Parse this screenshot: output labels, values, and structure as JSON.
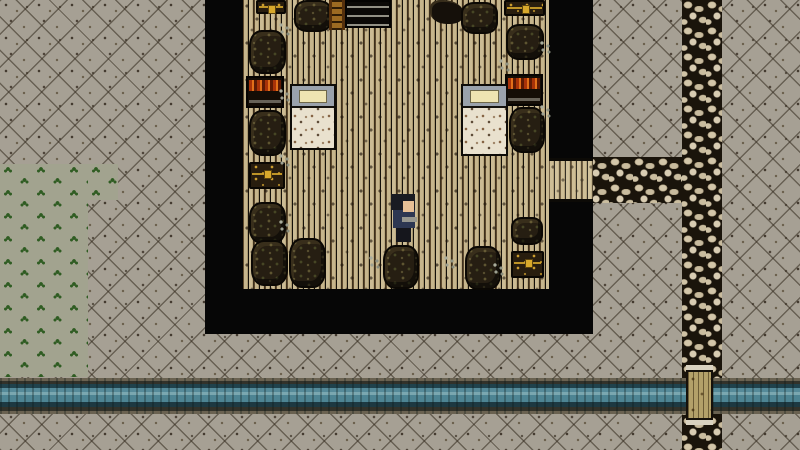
{
  "scene": {
    "type": "top-down-pixel-rpg",
    "viewport": {
      "width": 800,
      "height": 450
    },
    "colors": {
      "ground": "#a6a094",
      "grass": "#a2a38f",
      "sprout": "#2f5c22",
      "wood": "#bfae88",
      "wall": "#060606",
      "stone": "#d3c6a9",
      "stone_gap": "#1a140b",
      "water": "#4d8493",
      "bank": "#6a6251",
      "bridge": "#b3a069",
      "gold": "#d8a92c",
      "barrel": "#261e12",
      "chest": "#281d0e",
      "sheet": "#e9e1ce",
      "bedframe": "#9aa2ac",
      "pillow": "#eee4b2",
      "red_items": "#e2701a"
    },
    "entities": [
      {
        "type": "ground",
        "name": "exterior-ground",
        "x": 0,
        "y": 0,
        "w": 800,
        "h": 450,
        "interactable": false
      },
      {
        "type": "grass",
        "name": "grass-patch",
        "x": 0,
        "y": 164,
        "w": 88,
        "h": 213,
        "interactable": false
      },
      {
        "type": "grass",
        "name": "grass-patch-step",
        "x": 88,
        "y": 164,
        "w": 30,
        "h": 36,
        "interactable": false
      },
      {
        "type": "cobble",
        "name": "stone-path-vertical",
        "x": 682,
        "y": 0,
        "w": 40,
        "h": 450,
        "interactable": false
      },
      {
        "type": "cobble",
        "name": "stone-path-horizontal",
        "x": 585,
        "y": 157,
        "w": 97,
        "h": 46,
        "interactable": false
      },
      {
        "type": "river",
        "name": "river",
        "x": 0,
        "y": 378,
        "w": 800,
        "h": 36,
        "interactable": false
      },
      {
        "type": "bridge",
        "name": "wooden-bridge",
        "x": 686,
        "y": 370,
        "w": 27,
        "h": 50,
        "interactable": false
      },
      {
        "type": "wall",
        "name": "building-wall-left",
        "x": 205,
        "y": 0,
        "w": 38,
        "h": 334,
        "interactable": false
      },
      {
        "type": "wall",
        "name": "building-wall-bottom",
        "x": 205,
        "y": 289,
        "w": 388,
        "h": 45,
        "interactable": false
      },
      {
        "type": "wall",
        "name": "building-wall-right-top",
        "x": 549,
        "y": 0,
        "w": 44,
        "h": 158,
        "interactable": false
      },
      {
        "type": "wall",
        "name": "building-wall-right-bottom",
        "x": 549,
        "y": 202,
        "w": 44,
        "h": 88,
        "interactable": false
      },
      {
        "type": "floor",
        "name": "tavern-floor",
        "x": 243,
        "y": 0,
        "w": 306,
        "h": 289,
        "interactable": false
      },
      {
        "type": "porch",
        "name": "doorway-floor",
        "x": 549,
        "y": 158,
        "w": 44,
        "h": 44,
        "interactable": false
      },
      {
        "type": "chest",
        "name": "chest-top-left",
        "x": 256,
        "y": 0,
        "w": 30,
        "h": 14,
        "interactable": false
      },
      {
        "type": "barrel",
        "name": "barrel-top-1",
        "x": 294,
        "y": 0,
        "w": 38,
        "h": 32,
        "interactable": false
      },
      {
        "type": "ladder",
        "name": "ladder",
        "x": 329,
        "y": 0,
        "w": 16,
        "h": 30,
        "interactable": false
      },
      {
        "type": "shelf-dark",
        "name": "crate-shelf",
        "x": 345,
        "y": 0,
        "w": 46,
        "h": 28,
        "interactable": false
      },
      {
        "type": "tool",
        "name": "wall-tool",
        "x": 430,
        "y": 0,
        "w": 34,
        "h": 24,
        "interactable": false
      },
      {
        "type": "barrel",
        "name": "barrel-top-2",
        "x": 461,
        "y": 2,
        "w": 37,
        "h": 32,
        "interactable": false
      },
      {
        "type": "chest",
        "name": "chest-top-right",
        "x": 504,
        "y": 0,
        "w": 41,
        "h": 16,
        "interactable": false
      },
      {
        "type": "barrel",
        "name": "barrel-right-1",
        "x": 506,
        "y": 24,
        "w": 38,
        "h": 36,
        "interactable": false
      },
      {
        "type": "barrel",
        "name": "barrel-left-1",
        "x": 249,
        "y": 30,
        "w": 37,
        "h": 44,
        "interactable": false
      },
      {
        "type": "glint",
        "name": "floor-glint-1",
        "x": 278,
        "y": 22,
        "w": 14,
        "h": 16,
        "interactable": false
      },
      {
        "type": "shelf-red",
        "name": "weapon-shelf-left",
        "x": 246,
        "y": 76,
        "w": 38,
        "h": 32,
        "interactable": false
      },
      {
        "type": "shelf-red",
        "name": "weapon-shelf-right",
        "x": 505,
        "y": 74,
        "w": 38,
        "h": 32,
        "interactable": false
      },
      {
        "type": "bed",
        "name": "bed-left",
        "x": 290,
        "y": 84,
        "w": 46,
        "h": 66,
        "interactable": false
      },
      {
        "type": "bed",
        "name": "bed-right",
        "x": 461,
        "y": 84,
        "w": 47,
        "h": 72,
        "interactable": false
      },
      {
        "type": "barrel",
        "name": "barrel-left-2",
        "x": 249,
        "y": 110,
        "w": 37,
        "h": 46,
        "interactable": false
      },
      {
        "type": "barrel",
        "name": "barrel-right-2",
        "x": 509,
        "y": 107,
        "w": 36,
        "h": 46,
        "interactable": false
      },
      {
        "type": "glint",
        "name": "floor-glint-2",
        "x": 278,
        "y": 88,
        "w": 14,
        "h": 16,
        "interactable": false
      },
      {
        "type": "glint",
        "name": "floor-glint-3",
        "x": 539,
        "y": 40,
        "w": 14,
        "h": 16,
        "interactable": false
      },
      {
        "type": "glint",
        "name": "floor-glint-4",
        "x": 539,
        "y": 104,
        "w": 14,
        "h": 16,
        "interactable": false
      },
      {
        "type": "glint",
        "name": "floor-glint-5",
        "x": 498,
        "y": 58,
        "w": 14,
        "h": 16,
        "interactable": false
      },
      {
        "type": "chest",
        "name": "chest-left",
        "x": 249,
        "y": 162,
        "w": 36,
        "h": 27,
        "interactable": false
      },
      {
        "type": "glint",
        "name": "floor-glint-6",
        "x": 278,
        "y": 153,
        "w": 14,
        "h": 16,
        "interactable": false
      },
      {
        "type": "barrel",
        "name": "barrel-left-3",
        "x": 249,
        "y": 202,
        "w": 37,
        "h": 42,
        "interactable": false
      },
      {
        "type": "barrel",
        "name": "barrel-left-4",
        "x": 251,
        "y": 240,
        "w": 37,
        "h": 46,
        "interactable": false
      },
      {
        "type": "barrel",
        "name": "barrel-left-5",
        "x": 289,
        "y": 238,
        "w": 37,
        "h": 50,
        "interactable": false
      },
      {
        "type": "glint",
        "name": "floor-glint-7",
        "x": 278,
        "y": 219,
        "w": 14,
        "h": 16,
        "interactable": false
      },
      {
        "type": "barrel",
        "name": "barrel-center",
        "x": 383,
        "y": 245,
        "w": 36,
        "h": 44,
        "interactable": false
      },
      {
        "type": "barrel",
        "name": "barrel-bottom-right",
        "x": 465,
        "y": 246,
        "w": 36,
        "h": 44,
        "interactable": false
      },
      {
        "type": "barrel",
        "name": "barrel-right-3",
        "x": 511,
        "y": 217,
        "w": 32,
        "h": 28,
        "interactable": false
      },
      {
        "type": "chest",
        "name": "chest-bottom-right",
        "x": 511,
        "y": 251,
        "w": 33,
        "h": 27,
        "interactable": false
      },
      {
        "type": "glint",
        "name": "floor-glint-8",
        "x": 443,
        "y": 255,
        "w": 12,
        "h": 14,
        "interactable": false
      },
      {
        "type": "glint",
        "name": "floor-glint-9",
        "x": 492,
        "y": 262,
        "w": 12,
        "h": 14,
        "interactable": false
      },
      {
        "type": "glint",
        "name": "floor-glint-10",
        "x": 368,
        "y": 255,
        "w": 12,
        "h": 14,
        "interactable": false
      },
      {
        "type": "player",
        "name": "player-character",
        "x": 389,
        "y": 194,
        "w": 28,
        "h": 52,
        "interactable": false,
        "parts": [
          {
            "name": "player-body",
            "x": 4,
            "y": 16,
            "w": 22,
            "h": 18,
            "color": "#2d3752"
          },
          {
            "name": "player-hair",
            "x": 2,
            "y": 0,
            "w": 24,
            "h": 16,
            "color": "#191b22"
          },
          {
            "name": "player-face",
            "x": 14,
            "y": 7,
            "w": 11,
            "h": 11,
            "color": "#e6bf95"
          },
          {
            "name": "player-arm",
            "x": 13,
            "y": 23,
            "w": 15,
            "h": 5,
            "color": "#97978f"
          },
          {
            "name": "player-legs",
            "x": 7,
            "y": 34,
            "w": 15,
            "h": 14,
            "color": "#15161c"
          }
        ]
      }
    ]
  }
}
